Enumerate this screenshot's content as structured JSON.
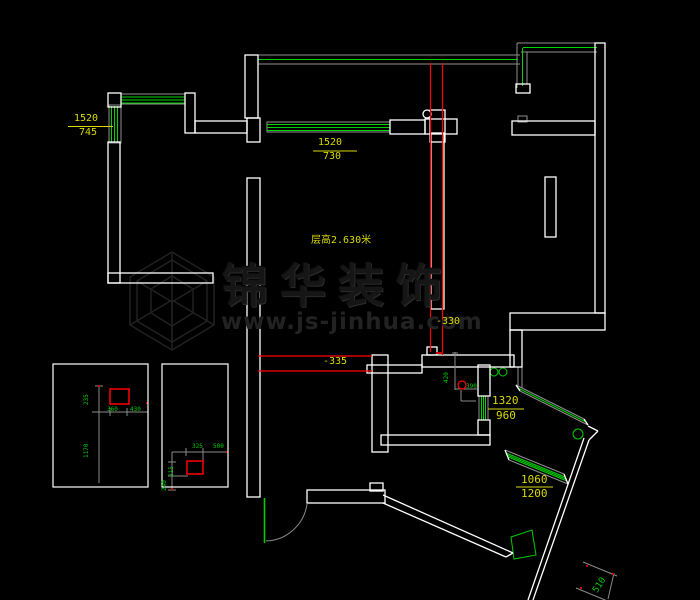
{
  "watermark": {
    "brand": "锦华装饰",
    "url": "www.js-jinhua.com"
  },
  "labels": {
    "win_left_top": {
      "main": "1520",
      "sub": "745"
    },
    "win_top_center": {
      "main": "1520",
      "sub": "730"
    },
    "ceiling": "层高2.630米",
    "level_a": "-330",
    "level_b": "-335",
    "win_right": {
      "main": "1320",
      "sub": "960"
    },
    "win_bay": {
      "main": "1060",
      "sub": "1200"
    },
    "dim_diag": "510"
  },
  "detail_box_1": {
    "h_top": "235",
    "h_bottom": "1170",
    "w1": "360",
    "w2": "430"
  },
  "detail_box_2": {
    "w1": "325",
    "w2": "500",
    "h1": "215",
    "h2": "240"
  },
  "bath": {
    "v": "420",
    "h": "390"
  },
  "colors": {
    "background": "#000000",
    "wall": "#ffffff",
    "window": "#00d400",
    "frame": "#8f8f8f",
    "dimension": "#ff0000",
    "label": "#d9d900",
    "small_label": "#00cc00"
  }
}
